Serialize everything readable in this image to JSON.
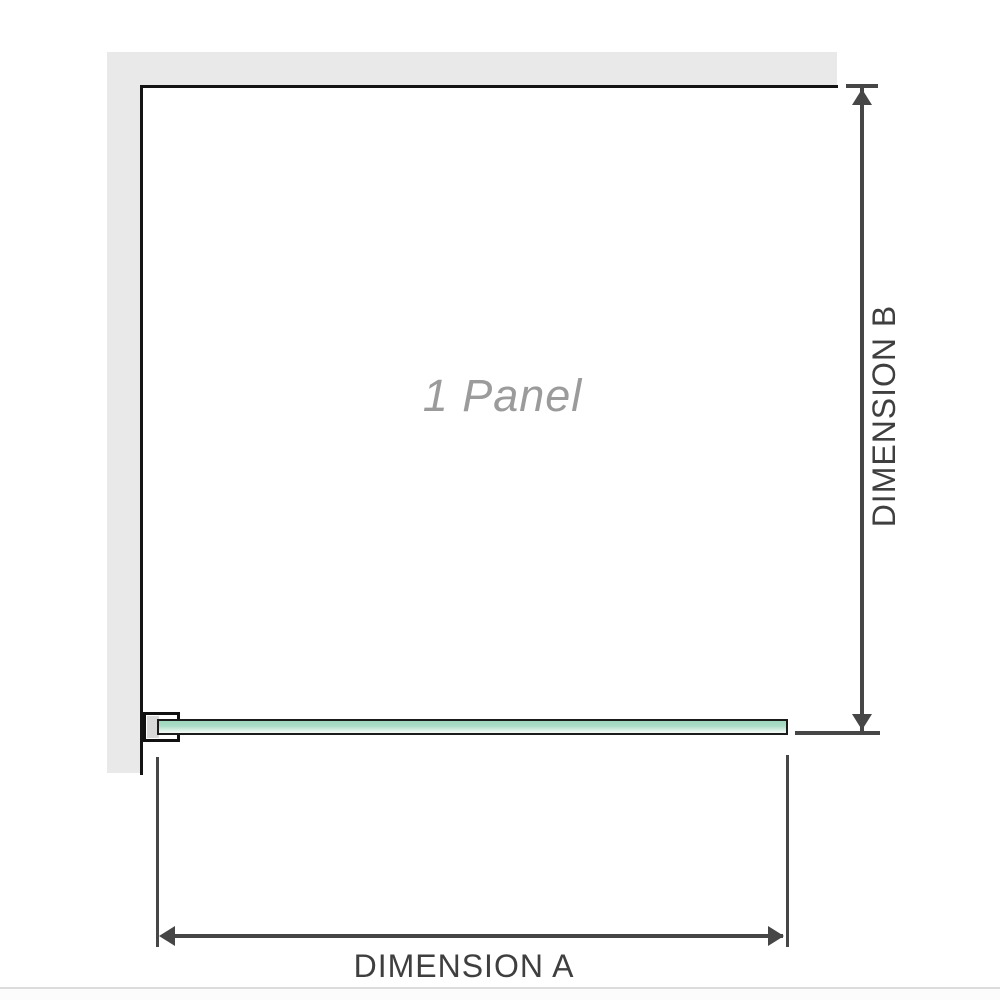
{
  "diagram": {
    "title": "1 Panel",
    "labels": {
      "dimension_a": "DIMENSION A",
      "dimension_b": "DIMENSION B"
    },
    "colors": {
      "wall_fill": "#e9e9e9",
      "wall_edge": "#141414",
      "glass_green_top": "#9ed7bd",
      "glass_green_bottom": "#f4faf7",
      "glass_border": "#1b1b1b",
      "bracket_border": "#111111",
      "bracket_inner_gray": "#d9d9d9",
      "dimension_line_gray": "#464646",
      "dimension_label_gray": "#3f3f3f",
      "panel_label_gray": "#9b9b9b",
      "footer_divider_gray": "#dcdcdc",
      "background": "#ffffff"
    }
  }
}
